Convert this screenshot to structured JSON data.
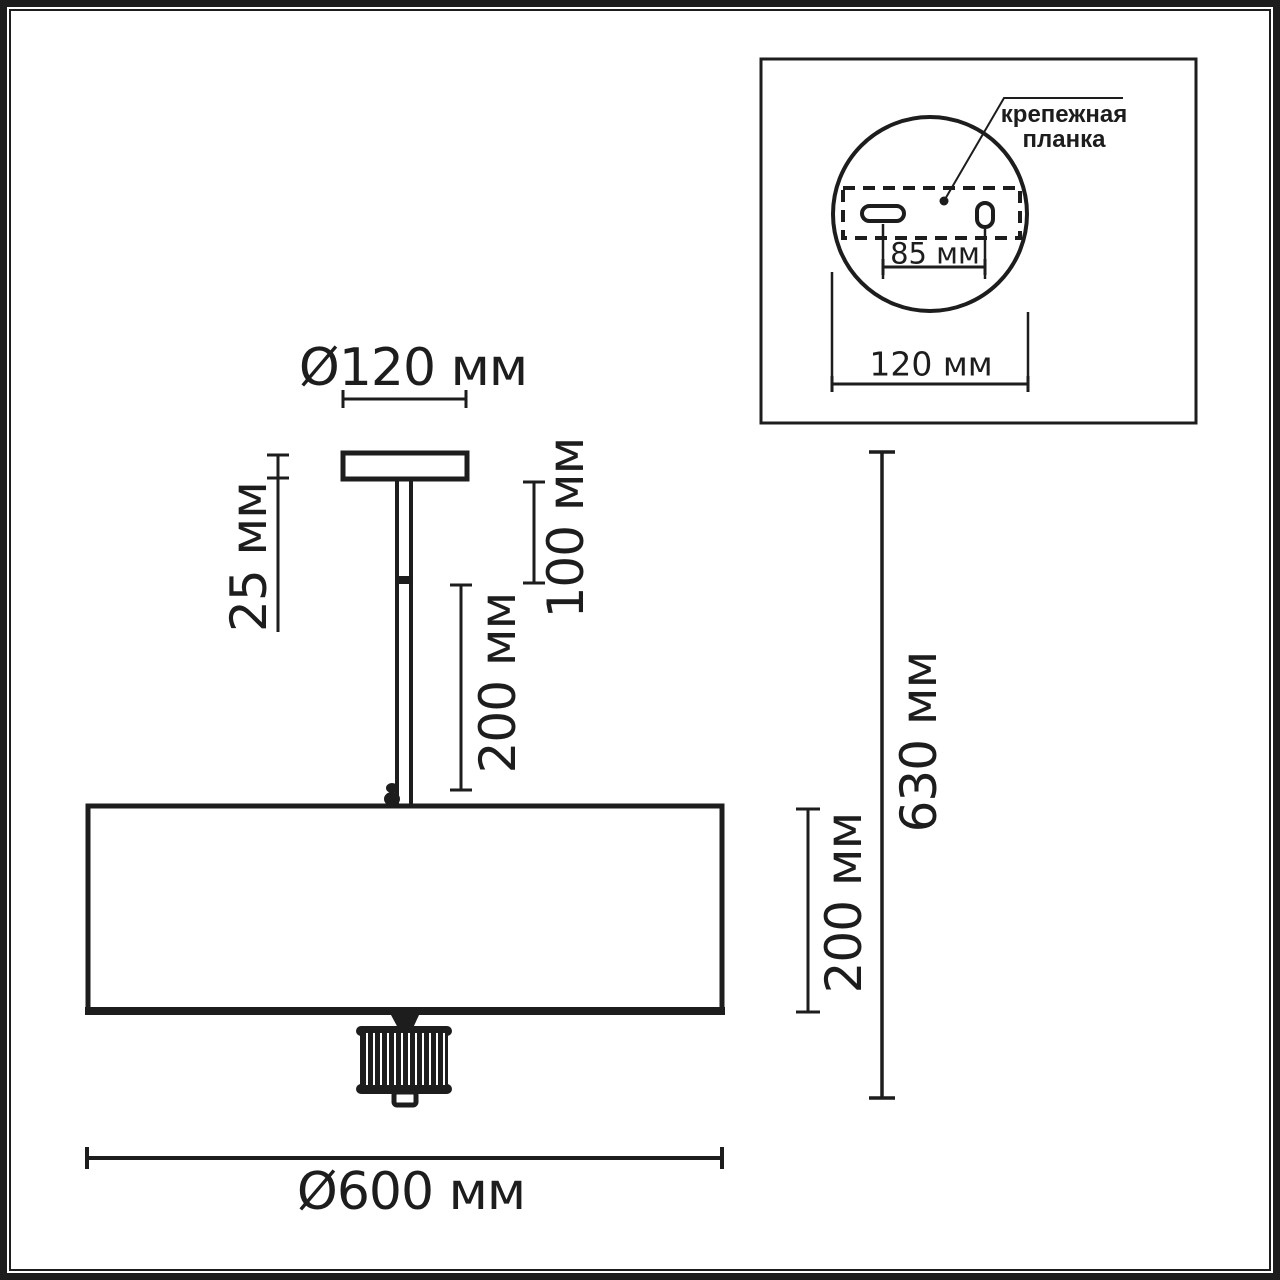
{
  "colors": {
    "ink": "#1d1d1d",
    "paper": "#ffffff"
  },
  "front_view": {
    "canopy_diameter_label": "Ø120 мм",
    "canopy_height_label": "25 мм",
    "stem_upper_label": "100 мм",
    "stem_lower_label": "200 мм",
    "total_height_label": "630 мм",
    "shade_height_label": "200 мм",
    "shade_diameter_label": "Ø600 мм"
  },
  "mount_inset": {
    "callout_label": "крепежная планка",
    "hole_spacing_label": "85 мм",
    "plate_diameter_label": "120 мм"
  },
  "measurements": {
    "canopy_diameter_mm": 120,
    "canopy_height_mm": 25,
    "stem_upper_mm": 100,
    "stem_lower_mm": 200,
    "total_height_mm": 630,
    "shade_height_mm": 200,
    "shade_diameter_mm": 600,
    "mount_hole_spacing_mm": 85,
    "mount_plate_diameter_mm": 120
  }
}
